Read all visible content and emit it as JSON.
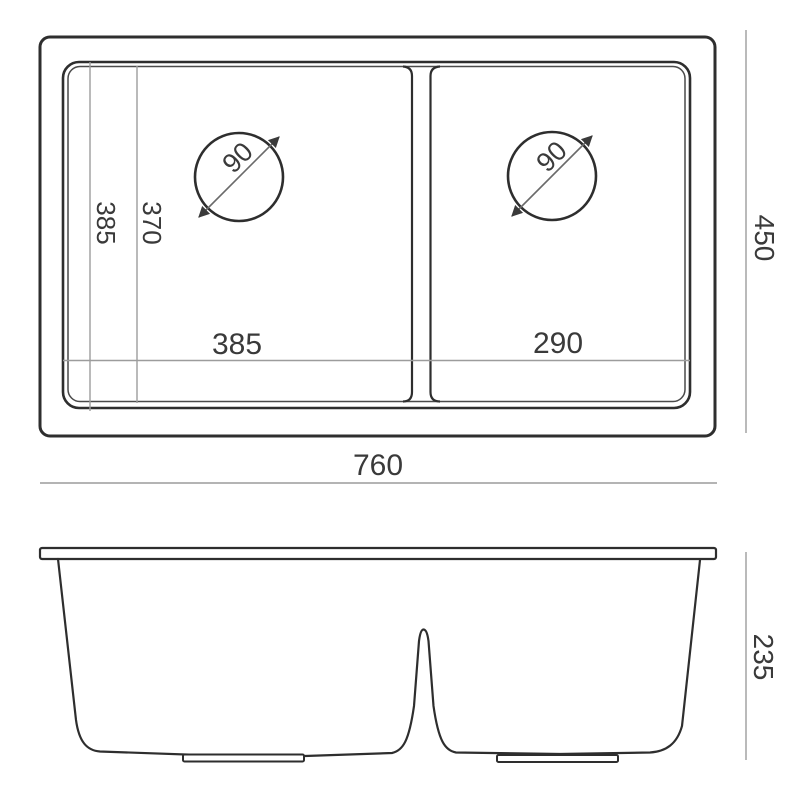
{
  "drawing": {
    "type": "double-bowl-sink-technical-drawing",
    "labels": {
      "overall_width": "760",
      "overall_depth": "450",
      "bowl1_width": "385",
      "bowl2_width": "290",
      "bowl_depth": "385",
      "bowl_base_depth": "370",
      "drain1_diameter": "90",
      "drain2_diameter": "90",
      "overall_height": "235"
    },
    "colors": {
      "outline": "#2e2e2e",
      "inner_line": "#4a4a4a",
      "dimension_line": "#9c9c9c",
      "text": "#3a3a3a",
      "background": "#ffffff"
    }
  }
}
